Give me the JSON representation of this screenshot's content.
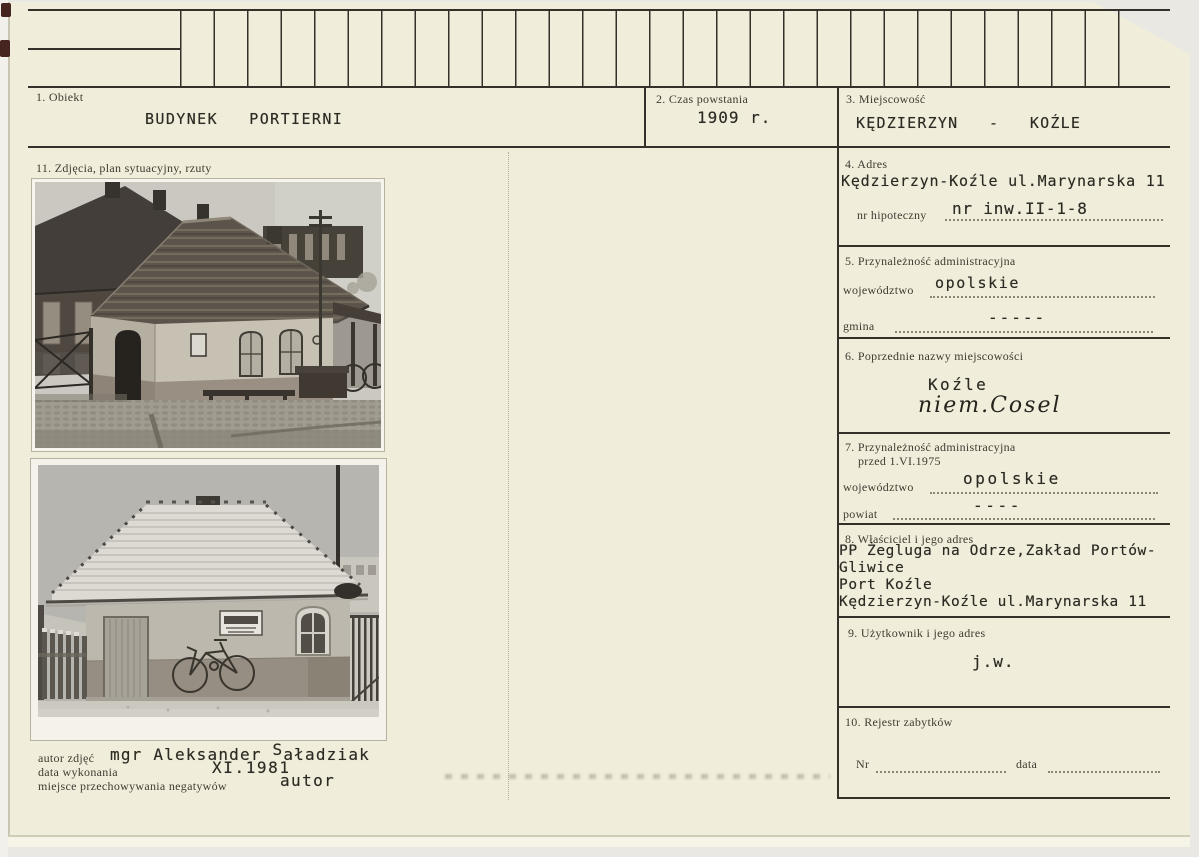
{
  "card": {
    "section1": {
      "label": "1. Obiekt",
      "value": "BUDYNEK   PORTIERNI"
    },
    "section2": {
      "label": "2. Czas powstania",
      "value": "1909 r."
    },
    "section3": {
      "label": "3. Miejscowość",
      "value": "KĘDZIERZYN   -   KOŹLE"
    },
    "section11": {
      "label": "11. Zdjęcia, plan sytuacyjny, rzuty"
    },
    "section4": {
      "label": "4. Adres",
      "address": "Kędzierzyn-Koźle ul.Marynarska 11",
      "hipoteczny_label": "nr hipoteczny",
      "hipoteczny_value": "nr inw.II-1-8"
    },
    "section5": {
      "label": "5. Przynależność administracyjna",
      "wojewodztwo_label": "województwo",
      "wojewodztwo_value": "opolskie",
      "gmina_label": "gmina",
      "gmina_value": "-----"
    },
    "section6": {
      "label": "6. Poprzednie nazwy miejscowości",
      "typed_name": "Koźle",
      "handwritten_name": "niem.Cosel"
    },
    "section7": {
      "label_line1": "7. Przynależność administracyjna",
      "label_line2": "przed 1.VI.1975",
      "wojewodztwo_label": "województwo",
      "wojewodztwo_value": "opolskie",
      "powiat_label": "powiat",
      "powiat_value": "----"
    },
    "section8": {
      "label": "8. Właściciel i jego adres",
      "lines": [
        "PP Żegluga na Odrze,Zakład Portów-",
        "Gliwice",
        "Port Koźle",
        "Kędzierzyn-Koźle ul.Marynarska 11"
      ]
    },
    "section9": {
      "label": "9. Użytkownik i jego adres",
      "value": "j.w."
    },
    "section10": {
      "label": "10. Rejestr zabytków",
      "nr_label": "Nr",
      "data_label": "data"
    },
    "footer": {
      "autor_label": "autor zdjęć",
      "autor_value_pre": "mgr Aleksander ",
      "autor_value_cap": "S",
      "autor_value_rest": "aładziak",
      "data_label": "data wykonania",
      "data_value": "XI.1981",
      "miejsce_label": "miejsce przechowywania negatywów",
      "miejsce_value": "autor"
    }
  }
}
